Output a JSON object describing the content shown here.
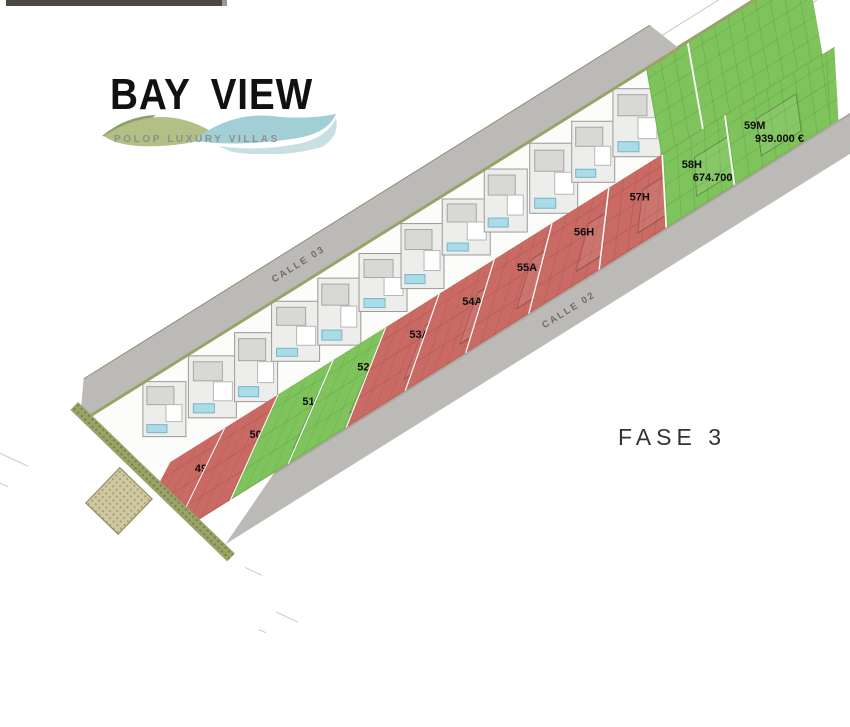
{
  "header": {
    "logo_title": "BAY VIEW",
    "logo_subtitle": "POLOP LUXURY VILLAS"
  },
  "phase_label": "FASE 3",
  "streets": [
    {
      "name": "CALLE 03"
    },
    {
      "name": "CALLE 02"
    }
  ],
  "colors": {
    "lot_red": "#c96a64",
    "lot_green": "#7fc35c",
    "road_gray": "#bcbab7",
    "hedge_olive": "#9aa467",
    "logo_wave_green": "#aebd7f",
    "logo_wave_blue": "#a2ced6"
  },
  "lots": [
    {
      "id": "49N",
      "color": "red",
      "price": ""
    },
    {
      "id": "50A",
      "color": "red",
      "price": ""
    },
    {
      "id": "51A",
      "color": "green",
      "price": "585.400 €"
    },
    {
      "id": "52A",
      "color": "green",
      "price": "570.400 €"
    },
    {
      "id": "53A",
      "color": "red",
      "price": ""
    },
    {
      "id": "54A",
      "color": "red",
      "price": ""
    },
    {
      "id": "55A",
      "color": "red",
      "price": ""
    },
    {
      "id": "56H",
      "color": "red",
      "price": ""
    },
    {
      "id": "57H",
      "color": "red",
      "price": ""
    },
    {
      "id": "58H",
      "color": "green",
      "price": "674.700 €"
    },
    {
      "id": "59M",
      "color": "green",
      "price": "939.000 €"
    }
  ]
}
